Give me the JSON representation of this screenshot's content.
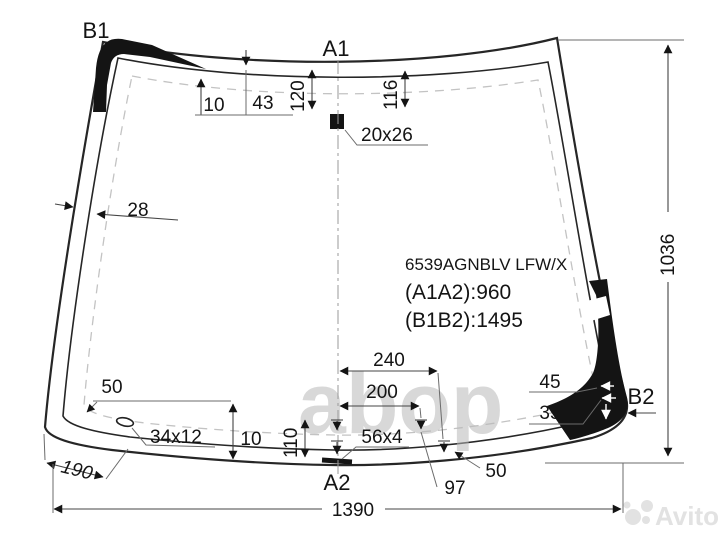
{
  "labels": {
    "b1": "B1",
    "a1": "A1",
    "b2": "B2",
    "a2": "A2"
  },
  "code_block": {
    "part_number": "6539AGNBLV LFW/X",
    "a1a2": "(A1A2):960",
    "b1b2": "(B1B2):1495"
  },
  "dims": {
    "d10_top": "10",
    "d43": "43",
    "d120": "120",
    "d116": "116",
    "d20x26": "20x26",
    "d28": "28",
    "d1036": "1036",
    "d240": "240",
    "d200": "200",
    "d45": "45",
    "d35": "35",
    "d50_right": "50",
    "d97": "97",
    "d56x4": "56x4",
    "d110": "110",
    "d10_bottom": "10",
    "d34x12": "34x12",
    "d50_left": "50",
    "d190": "190",
    "d1390": "1390"
  },
  "watermarks": {
    "center": "abop",
    "brand": "Avito"
  },
  "colors": {
    "outline": "#262626",
    "marker_black": "#141414",
    "dashed_band": "#c3c3c3",
    "center_watermark": "#b9b9b9",
    "brand_watermark": "#e2e2e2"
  }
}
